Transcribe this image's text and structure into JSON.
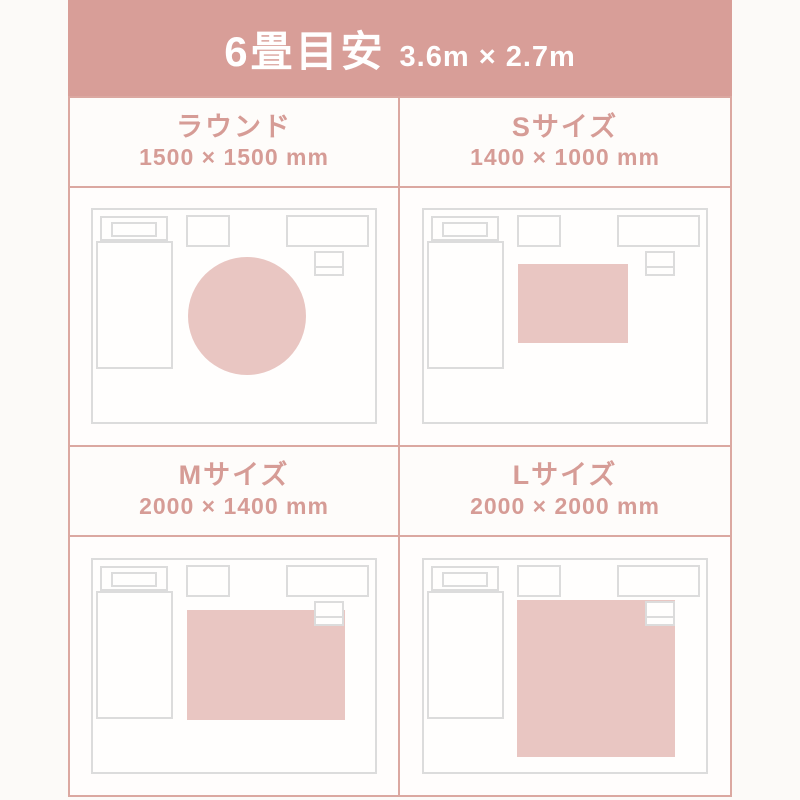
{
  "header": {
    "title": "6畳目安",
    "subtitle": "3.6m × 2.7m"
  },
  "panels": [
    {
      "id": "round",
      "title": "ラウンド",
      "dimensions": "1500 × 1500 mm",
      "rug_shape": "circle"
    },
    {
      "id": "s",
      "title": "Sサイズ",
      "dimensions": "1400 × 1000 mm",
      "rug_shape": "rect"
    },
    {
      "id": "m",
      "title": "Mサイズ",
      "dimensions": "2000 × 1400 mm",
      "rug_shape": "rect"
    },
    {
      "id": "l",
      "title": "Lサイズ",
      "dimensions": "2000 × 2000 mm",
      "rug_shape": "rect"
    }
  ],
  "colors": {
    "accent": "#d89e98",
    "rug": "#e9c6c2",
    "grid_border": "#dba8a1",
    "furniture_border": "#dcdcdc",
    "background": "#fcfaf8",
    "panel_background": "#fffdfc",
    "header_text": "#ffffff",
    "panel_text": "#d69c96"
  }
}
